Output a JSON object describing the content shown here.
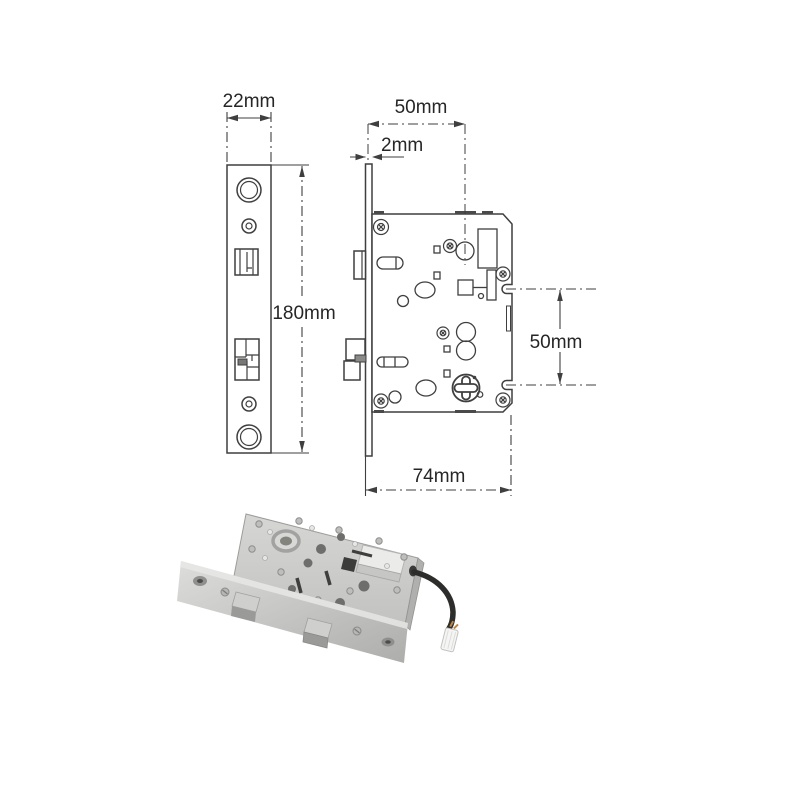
{
  "page": {
    "background_color": "#ffffff"
  },
  "drawing": {
    "line_color": "#3f3f3f",
    "text_color": "#262626",
    "dimensions": {
      "faceplate_width": "22mm",
      "backset": "50mm",
      "faceplate_thickness": "2mm",
      "faceplate_height": "180mm",
      "fixing_hole_spacing": "50mm",
      "body_width": "74mm"
    }
  },
  "photo": {
    "steel_light": "#e8e8e6",
    "steel_face": "#cdcdcb",
    "steel_mid": "#b1b1af",
    "steel_dark": "#8f8f8d",
    "hole_dark": "#6e6e6c",
    "cable_color": "#2d2d2b",
    "connector_color": "#f5f5f3",
    "wire_tip_color": "#c08545"
  }
}
